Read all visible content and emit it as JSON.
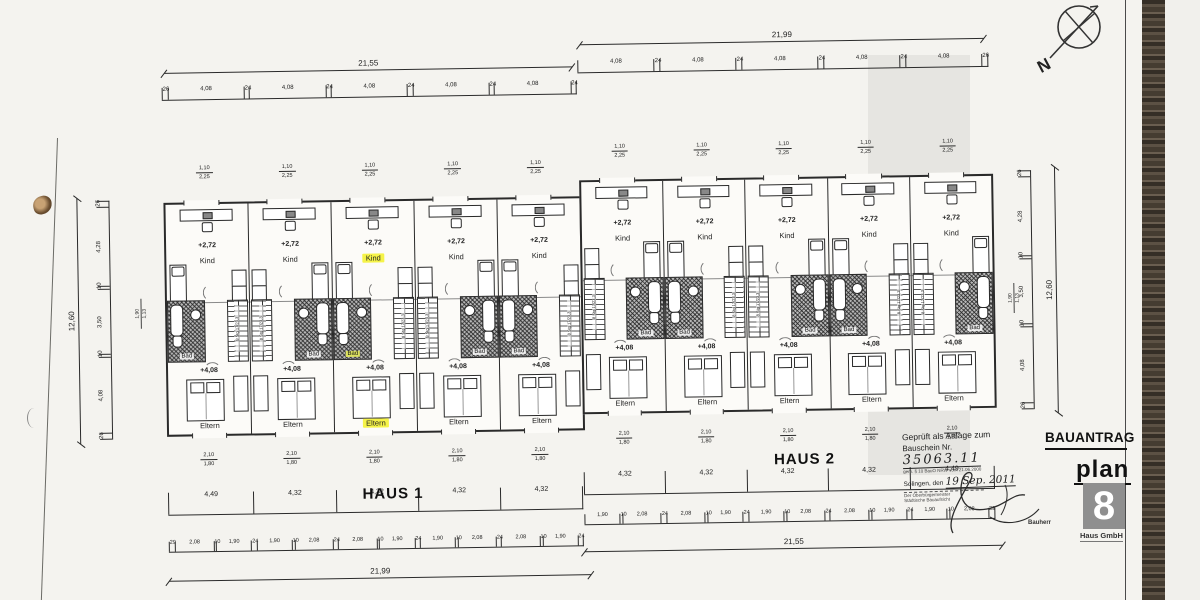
{
  "document": {
    "type": "scanned architectural floor plan",
    "compass_label": "N"
  },
  "title_block": {
    "title": "BAUANTRAG",
    "logo_word": "plan",
    "logo_digit": "8",
    "logo_company": "Haus GmbH",
    "side_label": "Bauherr"
  },
  "approval_stamp": {
    "line1": "Geprüft als Anlage zum",
    "bauschein_label": "Bauschein Nr.",
    "bauschein_number": "35063.11",
    "legal_note": "gem. § 10 BauO NRW vom 21.06.2000",
    "city_label": "Solingen, den",
    "date_value": "19 Sep. 2011",
    "authority1": "Der Oberbürgermeister",
    "authority2": "Städtische Bauaufsicht"
  },
  "stair_note": "8 Stg 17/23,3",
  "vertical_dims": {
    "overall": "12,60",
    "segments_top_to_bottom": [
      "26",
      "4,28",
      "10",
      "3,50",
      "10",
      "4,08",
      "26"
    ],
    "sill_values": [
      "1,90",
      "1,13"
    ]
  },
  "houses": [
    {
      "name": "HAUS 1",
      "dim_top_overall": "21,55",
      "dim_top_row": [
        "26",
        "4,08",
        "24",
        "4,08",
        "24",
        "4,08",
        "24",
        "4,08",
        "24",
        "4,08",
        "24"
      ],
      "dim_bottom_rowA": [
        "4,49",
        "4,32",
        "4,32",
        "4,32",
        "4,32"
      ],
      "dim_bottom_rowB": [
        "29",
        "2,08",
        "10",
        "1,90",
        "24",
        "1,90",
        "10",
        "2,08",
        "24",
        "2,08",
        "10",
        "1,90",
        "24",
        "1,90",
        "10",
        "2,08",
        "24",
        "2,08",
        "10",
        "1,90",
        "24"
      ],
      "dim_bottom_overall": "21,99",
      "window_dim_top": {
        "w": "1,10",
        "h": "2,25"
      },
      "window_dim_bottom": {
        "w": "2,10",
        "h": "1,80"
      },
      "units": [
        {
          "level_upper": "+2,72",
          "room_upper": "Kind",
          "room_bath": "Bad",
          "level_lower": "+4,08",
          "room_lower": "Eltern",
          "bath_side": "left",
          "highlight_upper": false,
          "highlight_bath": false,
          "highlight_lower": false
        },
        {
          "level_upper": "+2,72",
          "room_upper": "Kind",
          "room_bath": "Bad",
          "level_lower": "+4,08",
          "room_lower": "Eltern",
          "bath_side": "right",
          "highlight_upper": false,
          "highlight_bath": false,
          "highlight_lower": false
        },
        {
          "level_upper": "+2,72",
          "room_upper": "Kind",
          "room_bath": "Bad",
          "level_lower": "+4,08",
          "room_lower": "Eltern",
          "bath_side": "left",
          "highlight_upper": true,
          "highlight_bath": true,
          "highlight_lower": true
        },
        {
          "level_upper": "+2,72",
          "room_upper": "Kind",
          "room_bath": "Bad",
          "level_lower": "+4,08",
          "room_lower": "Eltern",
          "bath_side": "right",
          "highlight_upper": false,
          "highlight_bath": false,
          "highlight_lower": false
        },
        {
          "level_upper": "+2,72",
          "room_upper": "Kind",
          "room_bath": "Bad",
          "level_lower": "+4,08",
          "room_lower": "Eltern",
          "bath_side": "left",
          "highlight_upper": false,
          "highlight_bath": false,
          "highlight_lower": false
        }
      ]
    },
    {
      "name": "HAUS 2",
      "dim_top_overall": "21,99",
      "dim_top_row": [
        "4,08",
        "24",
        "4,08",
        "24",
        "4,08",
        "24",
        "4,08",
        "24",
        "4,08",
        "26"
      ],
      "dim_bottom_rowA": [
        "4,32",
        "4,32",
        "4,32",
        "4,32",
        "4,49"
      ],
      "dim_bottom_rowB": [
        "1,90",
        "10",
        "2,08",
        "24",
        "2,08",
        "10",
        "1,90",
        "24",
        "1,90",
        "10",
        "2,08",
        "24",
        "2,08",
        "10",
        "1,90",
        "24",
        "1,90",
        "10",
        "2,08",
        "29"
      ],
      "dim_bottom_overall": "21,55",
      "window_dim_top": {
        "w": "1,10",
        "h": "2,25"
      },
      "window_dim_bottom": {
        "w": "2,10",
        "h": "1,80"
      },
      "units": [
        {
          "level_upper": "+2,72",
          "room_upper": "Kind",
          "room_bath": "Bad",
          "level_lower": "+4,08",
          "room_lower": "Eltern",
          "bath_side": "right",
          "highlight_upper": false,
          "highlight_bath": false,
          "highlight_lower": false
        },
        {
          "level_upper": "+2,72",
          "room_upper": "Kind",
          "room_bath": "Bad",
          "level_lower": "+4,08",
          "room_lower": "Eltern",
          "bath_side": "left",
          "highlight_upper": false,
          "highlight_bath": false,
          "highlight_lower": false
        },
        {
          "level_upper": "+2,72",
          "room_upper": "Kind",
          "room_bath": "Bad",
          "level_lower": "+4,08",
          "room_lower": "Eltern",
          "bath_side": "right",
          "highlight_upper": false,
          "highlight_bath": false,
          "highlight_lower": false
        },
        {
          "level_upper": "+2,72",
          "room_upper": "Kind",
          "room_bath": "Bad",
          "level_lower": "+4,08",
          "room_lower": "Eltern",
          "bath_side": "left",
          "highlight_upper": false,
          "highlight_bath": false,
          "highlight_lower": false
        },
        {
          "level_upper": "+2,72",
          "room_upper": "Kind",
          "room_bath": "Bad",
          "level_lower": "+4,08",
          "room_lower": "Eltern",
          "bath_side": "right",
          "highlight_upper": false,
          "highlight_bath": false,
          "highlight_lower": false
        }
      ]
    }
  ],
  "colors": {
    "line": "#2a2a2a",
    "paper": "#f4f3ef",
    "highlight_yellow": "#f5f348",
    "highlight_green": "#dce25f",
    "logo_gray": "#8f8f8f"
  }
}
